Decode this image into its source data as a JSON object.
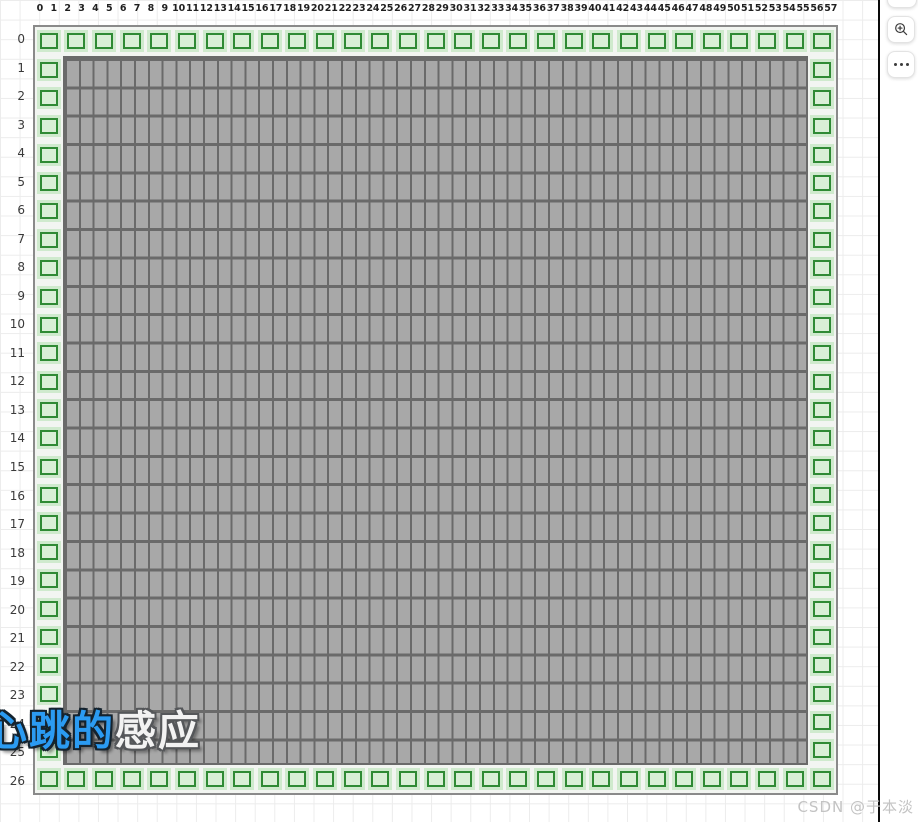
{
  "header": {
    "col_labels": [
      "0",
      "1",
      "2",
      "3",
      "4",
      "5",
      "6",
      "7",
      "8",
      "9",
      "10",
      "11",
      "12",
      "13",
      "14",
      "15",
      "16",
      "17",
      "18",
      "19",
      "20",
      "21",
      "22",
      "23",
      "24",
      "25",
      "26",
      "27",
      "28",
      "29",
      "30",
      "31",
      "32",
      "33",
      "34",
      "35",
      "36",
      "37",
      "38",
      "39",
      "40",
      "41",
      "42",
      "43",
      "44",
      "45",
      "46",
      "47",
      "48",
      "49",
      "50",
      "51",
      "52",
      "53",
      "54",
      "55",
      "56",
      "57"
    ]
  },
  "rows": {
    "labels": [
      "0",
      "1",
      "2",
      "3",
      "4",
      "5",
      "6",
      "7",
      "8",
      "9",
      "10",
      "11",
      "12",
      "13",
      "14",
      "15",
      "16",
      "17",
      "18",
      "19",
      "20",
      "21",
      "22",
      "23",
      "24",
      "25",
      "26"
    ]
  },
  "map": {
    "cols": 58,
    "rows": 27,
    "top_wall_count": 29,
    "bottom_wall_count": 29,
    "left_wall_count": 25,
    "right_wall_count": 25,
    "colors": {
      "wall_bg": "#cfeacd",
      "wall_inner": "#d9efd6",
      "wall_border": "#2f8a34",
      "floor_bg": "#a8a8a8",
      "floor_line": "#6a6a6a",
      "map_edge": "#8a8a8a",
      "bg_line": "#ececec",
      "divider": "#0a0a0a"
    }
  },
  "watermarks": {
    "logo_blue": "心跳的",
    "logo_light": "感应",
    "csdn": "CSDN @于本淡"
  },
  "side_panel": {
    "buttons": [
      {
        "name": "cropped-top-button",
        "icon": "cropped-button-icon"
      },
      {
        "name": "zoom-in-button",
        "icon": "magnifier-plus-icon"
      },
      {
        "name": "more-options-button",
        "icon": "ellipsis-icon"
      }
    ]
  }
}
